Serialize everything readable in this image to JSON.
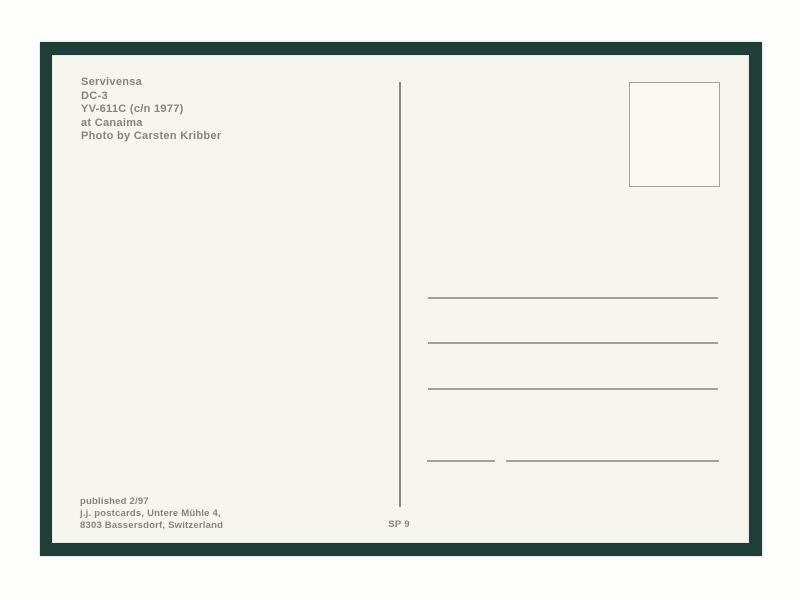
{
  "postcard": {
    "caption": {
      "line1": "Servivensa",
      "line2": "DC-3",
      "line3": "YV-611C (c/n 1977)",
      "line4": "at Canaima",
      "line5": "Photo by Carsten Kribber"
    },
    "publisher": {
      "line1": "published 2/97",
      "line2": "j.j. postcards, Untere Mühle 4,",
      "line3": "8303 Bassersdorf, Switzerland"
    },
    "series_code": "SP 9",
    "address_lines_count": 4,
    "colors": {
      "frame": "#1f3e38",
      "card": "#f6f5ee",
      "text": "#85857d",
      "rule": "#a0a099",
      "background": "#fdfdfc"
    }
  }
}
